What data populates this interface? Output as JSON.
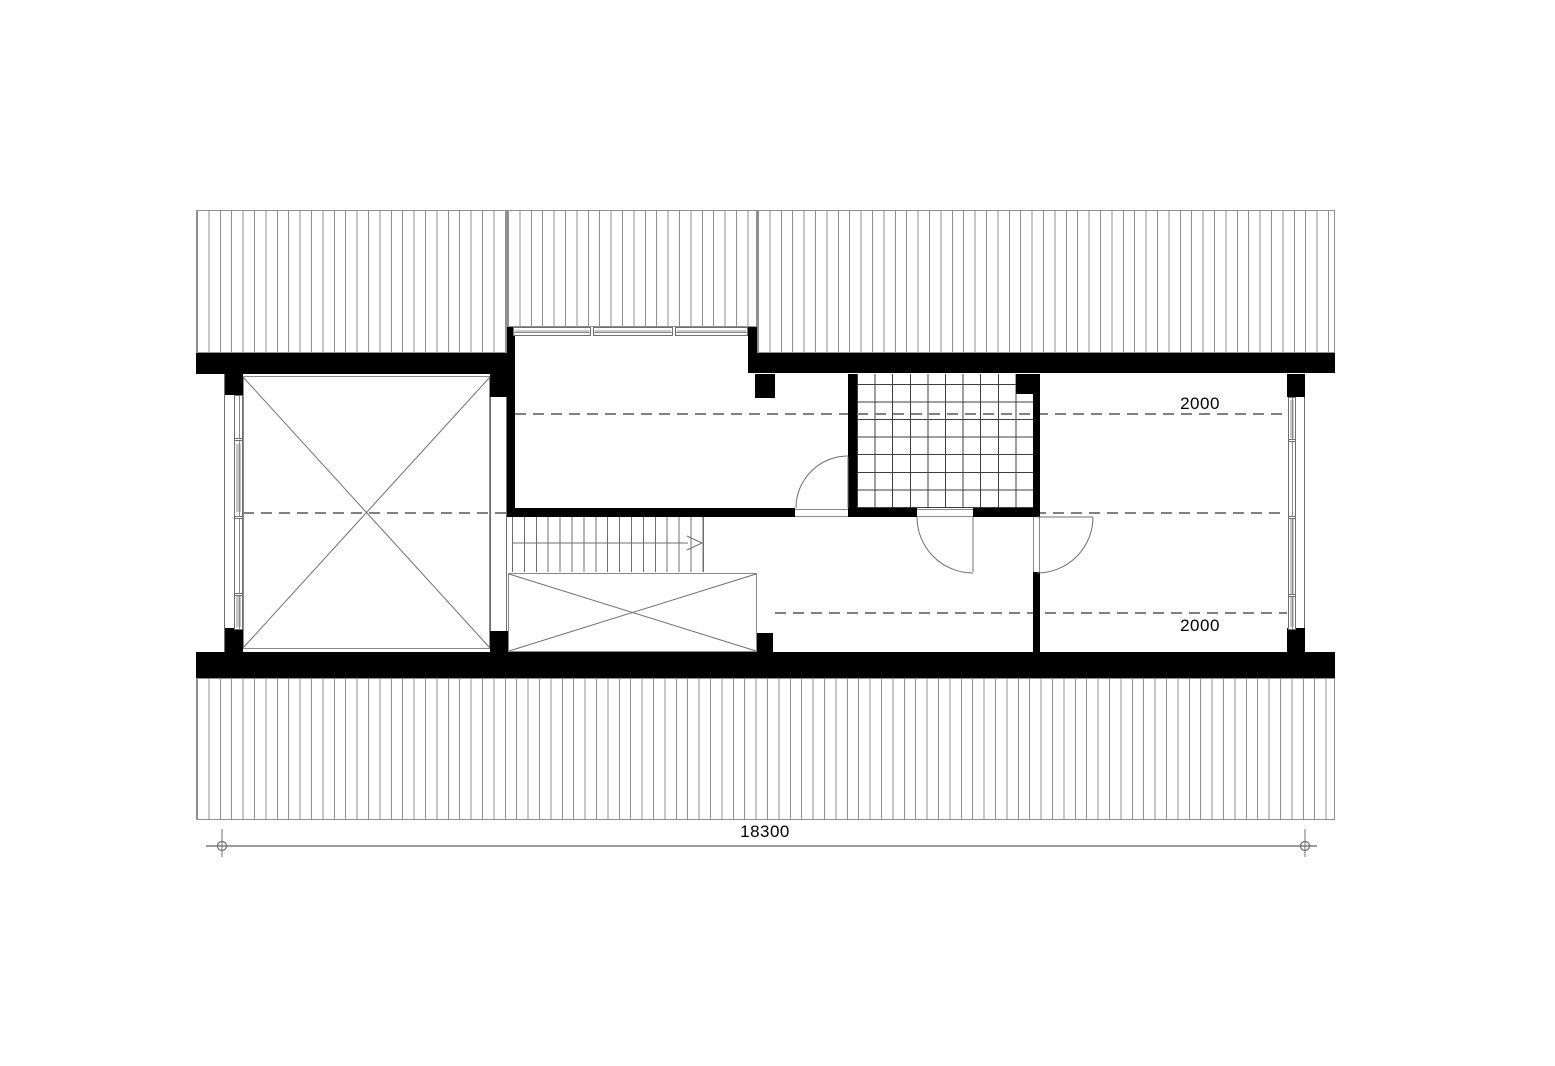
{
  "floor_plan": {
    "description": "attic floor plan with roof hatching above and below, void with X, dormer room, stair, bathroom with tiled floor, and bedroom",
    "annotations": {
      "headroom_top": "2000",
      "headroom_bottom": "2000"
    },
    "dimension": {
      "overall_length": "18300"
    },
    "colors": {
      "wall": "#000000",
      "thin_line": "#6f6f6f",
      "room_border": "#8a8a8a",
      "hatch_line": "#909090",
      "dash_line": "#808080",
      "tile_line": "#3f3f3f",
      "glazing_fill": "#c8c8c8",
      "dim_line": "#9c9c9c",
      "text": "#000000",
      "background": "#ffffff"
    }
  }
}
